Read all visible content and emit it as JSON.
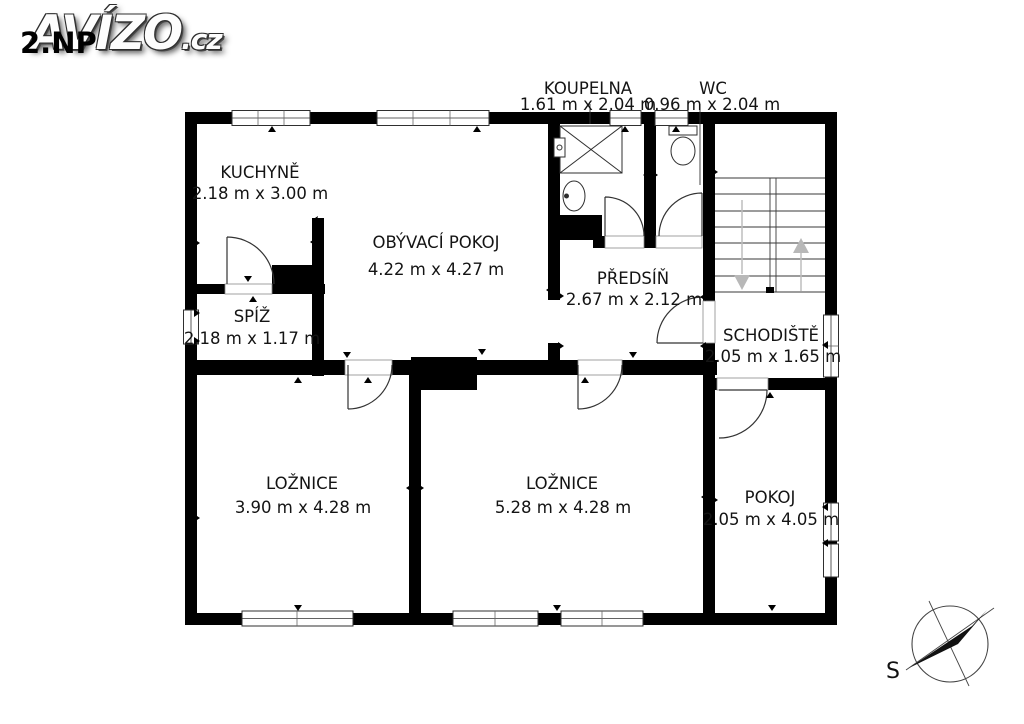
{
  "logo": {
    "floor_label": "2.NP",
    "brand": "AVÍZO",
    "brand_suffix": ".cz"
  },
  "compass": {
    "north_label": "S"
  },
  "rooms": {
    "kuchyne": {
      "name": "KUCHYNĚ",
      "dims": "2.18 m x 3.00 m"
    },
    "obyvaci_pokoj": {
      "name": "OBÝVACÍ POKOJ",
      "dims": "4.22 m x 4.27 m"
    },
    "koupelna": {
      "name": "KOUPELNA",
      "dims": "1.61 m x 2.04 m"
    },
    "wc": {
      "name": "WC",
      "dims": "0.96 m x 2.04 m"
    },
    "predsin": {
      "name": "PŘEDSÍŇ",
      "dims": "2.67 m x 2.12 m"
    },
    "spiz": {
      "name": "SPÍŽ",
      "dims": "2.18 m x 1.17 m"
    },
    "schodiste": {
      "name": "SCHODIŠTĚ",
      "dims": "2.05 m x 1.65 m"
    },
    "loznice_1": {
      "name": "LOŽNICE",
      "dims": "3.90 m x 4.28 m"
    },
    "loznice_2": {
      "name": "LOŽNICE",
      "dims": "5.28 m x 4.28 m"
    },
    "pokoj": {
      "name": "POKOJ",
      "dims": "2.05 m x 4.05 m"
    }
  },
  "colors": {
    "background": "#ffffff",
    "walls": "#000000",
    "text": "#141414",
    "stair_arrows": "#b8b8b8"
  }
}
